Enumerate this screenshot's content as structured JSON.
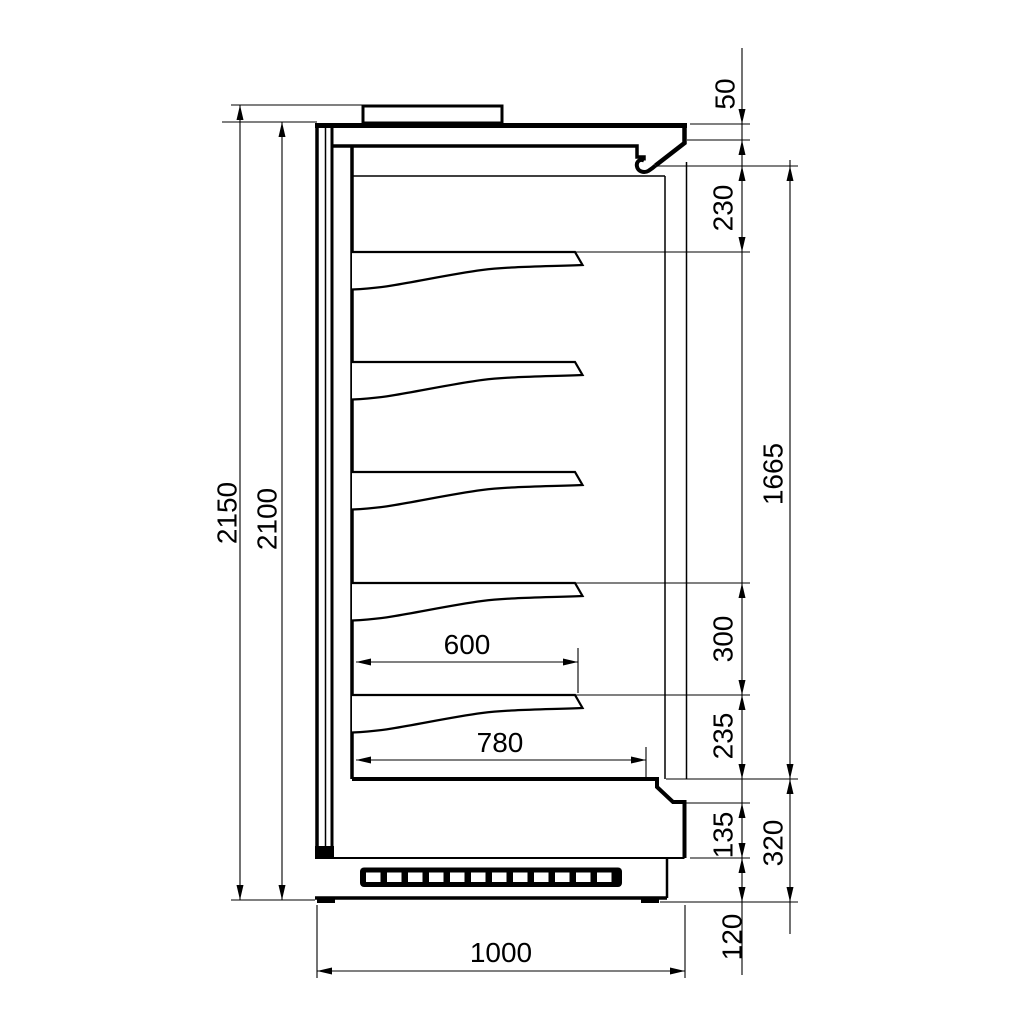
{
  "drawing": {
    "kind": "technical-section-drawing",
    "subject": "multideck display cabinet side section",
    "background_color": "#ffffff",
    "line_color": "#000000"
  },
  "labels": {
    "overall_height": "2150",
    "body_height": "2100",
    "top_gap": "50",
    "first_shelf_gap": "230",
    "display_opening_height": "1665",
    "shelf_pitch": "300",
    "lowest_shelf_gap": "235",
    "front_step_height": "135",
    "plinth_height": "120",
    "base_height": "320",
    "shelf_depth": "600",
    "bottom_deck_depth": "780",
    "overall_depth": "1000"
  }
}
